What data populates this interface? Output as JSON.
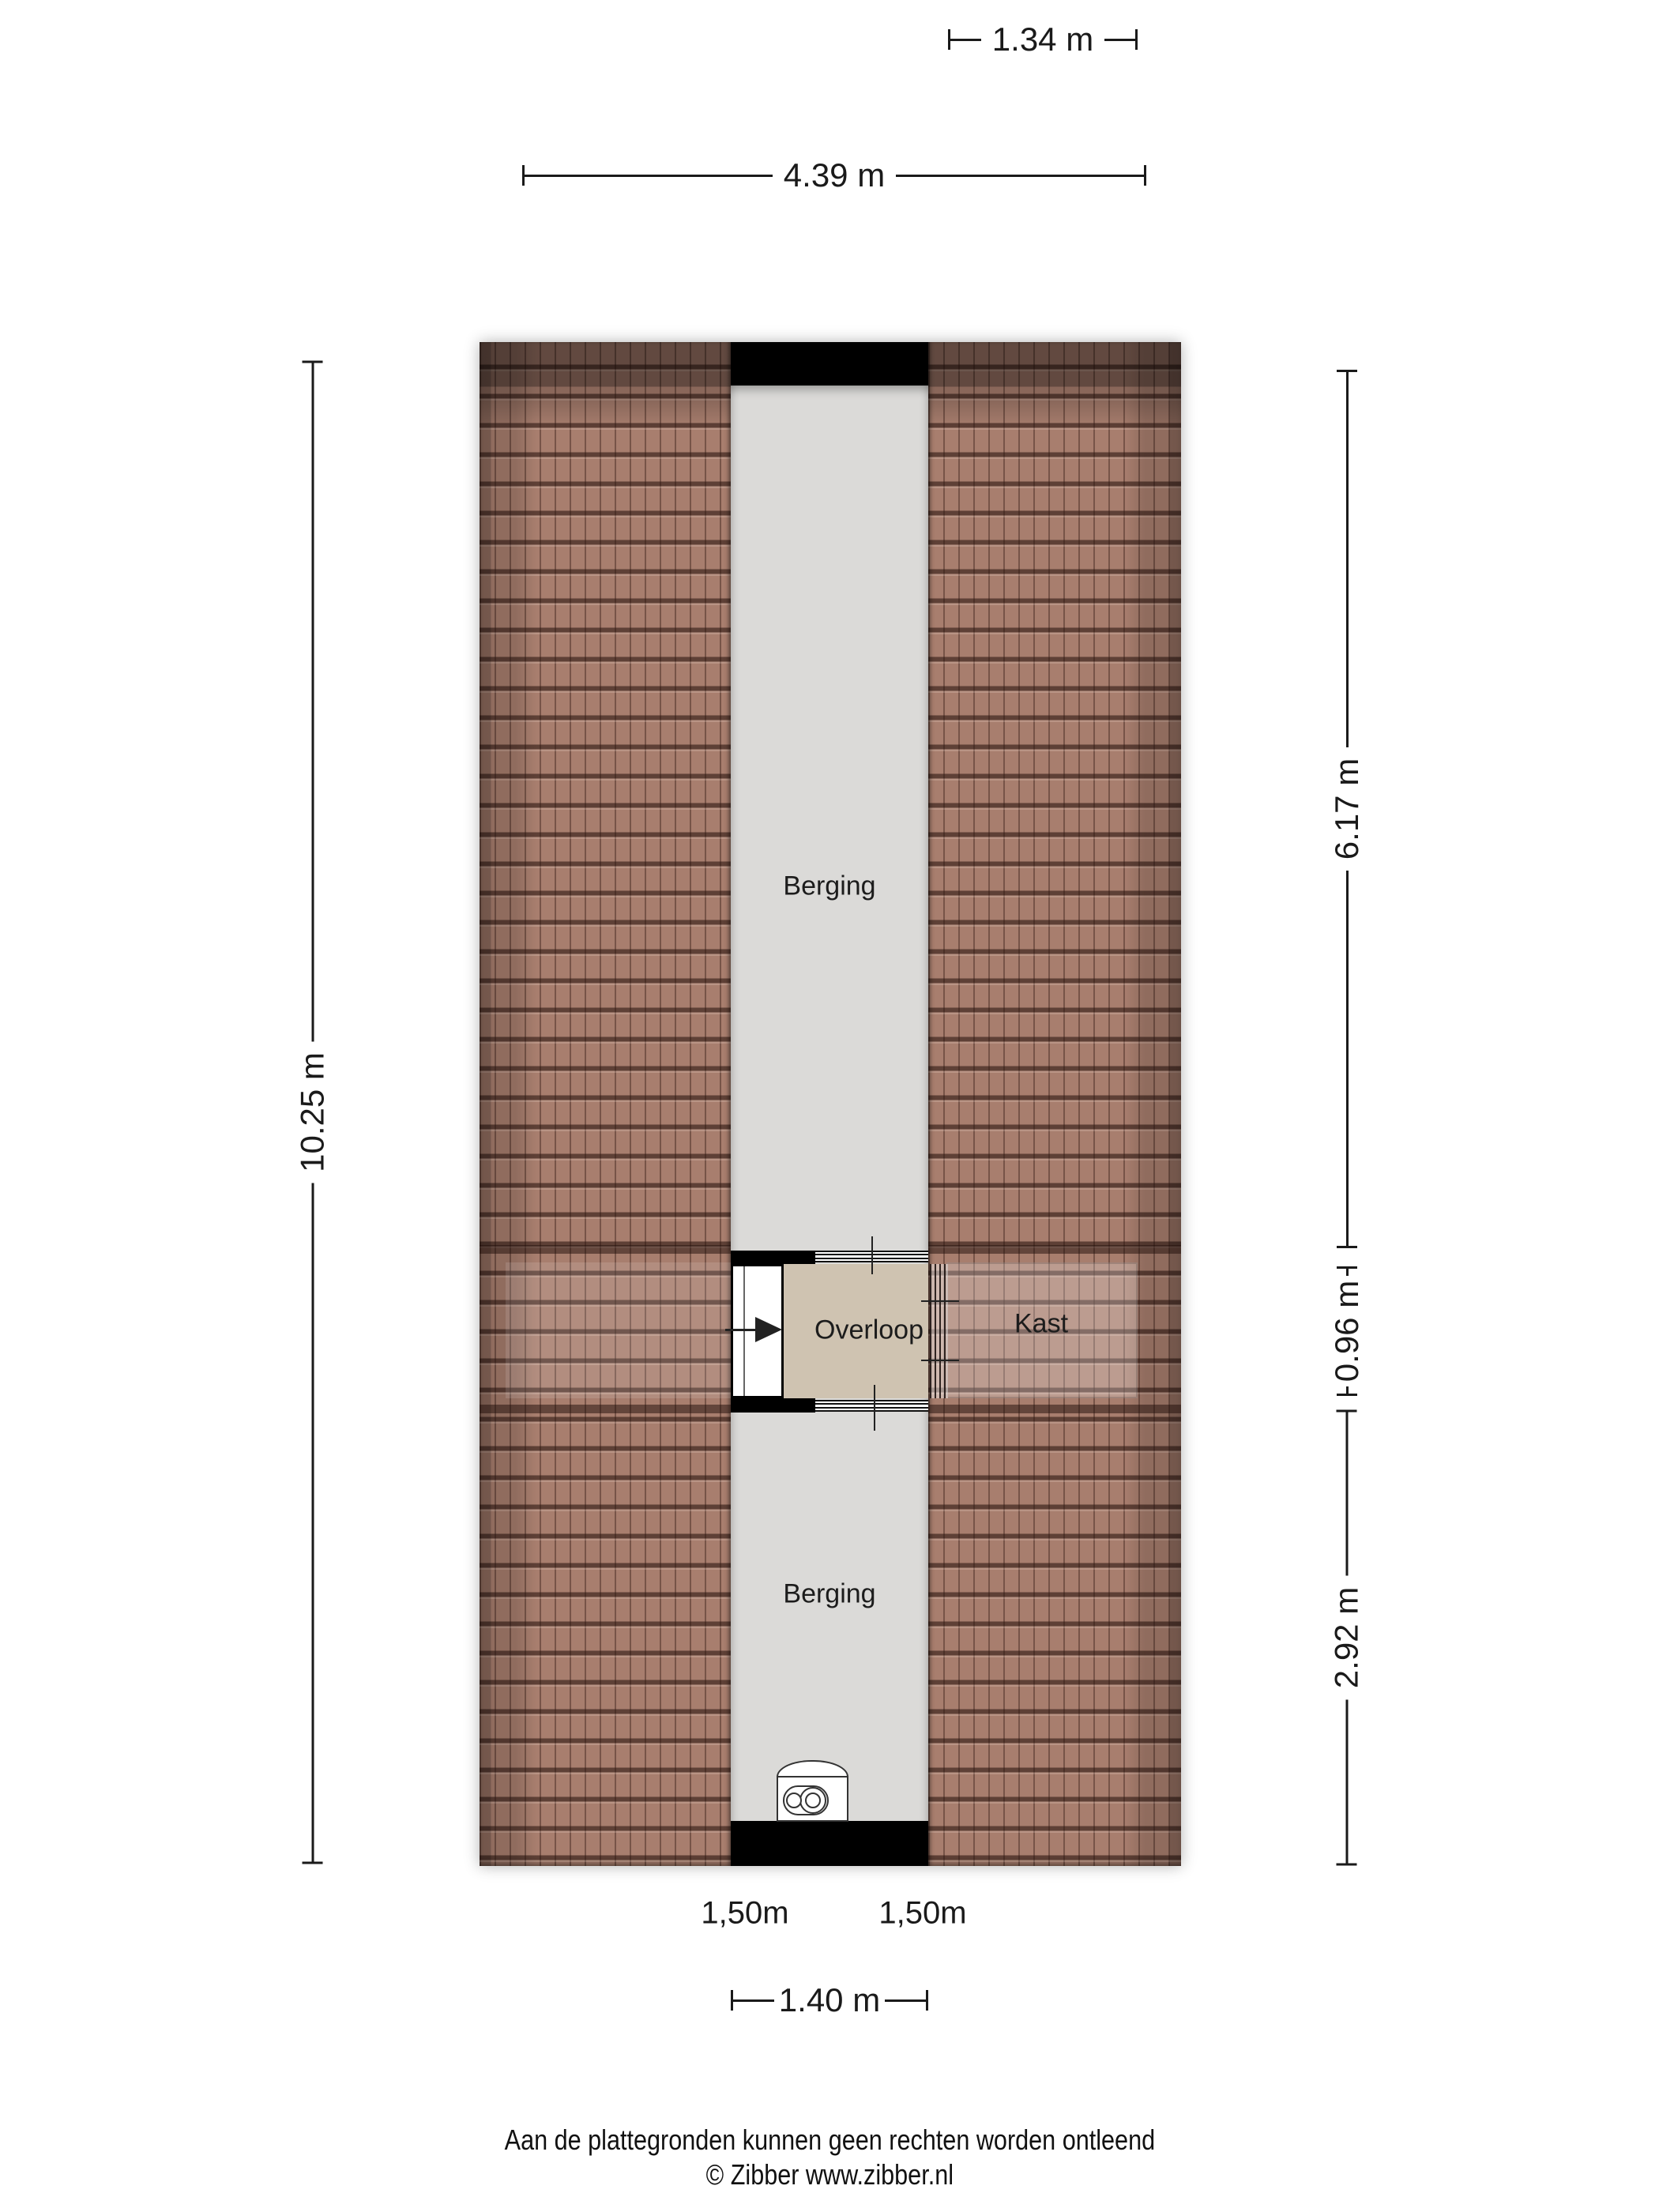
{
  "rooms": {
    "berging_top": "Berging",
    "overloop": "Overloop",
    "kast": "Kast",
    "berging_bottom": "Berging"
  },
  "dimensions": {
    "top_inner": "1.34 m",
    "top_outer": "4.39 m",
    "left": "10.25 m",
    "right_upper": "6.17 m",
    "right_middle": "0.96 m",
    "right_lower": "2.92 m",
    "bottom": "1.40 m",
    "headroom_left": "1,50m",
    "headroom_right": "1,50m"
  },
  "footer": {
    "disclaimer": "Aan de plattegronden kunnen geen rechten worden ontleend",
    "copyright": "© Zibber www.zibber.nl"
  },
  "colors": {
    "roof_tile": "#a87e6e",
    "roof_line": "#3a241d",
    "corridor_floor": "#dbdad8",
    "overloop_floor": "#cfc3b1",
    "wall": "#000000",
    "dimension_text": "#1a1a1a"
  }
}
